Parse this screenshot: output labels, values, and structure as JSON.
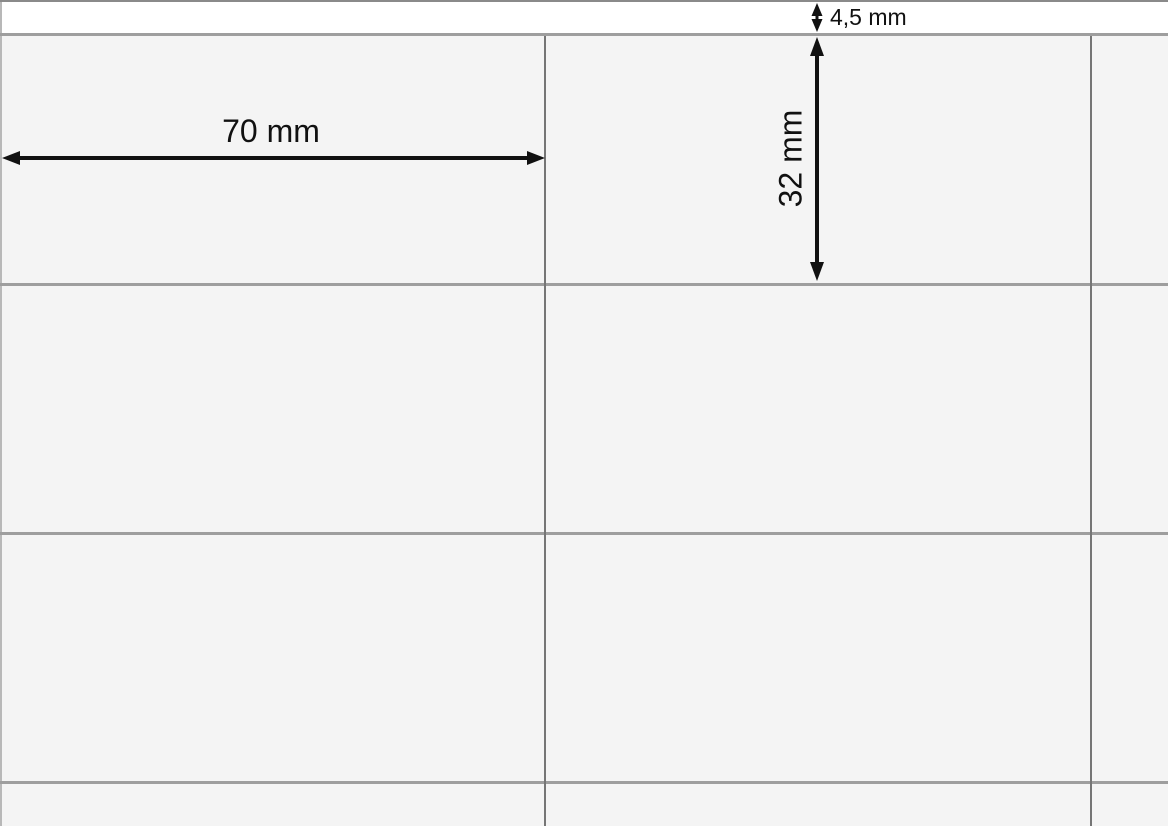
{
  "diagram": {
    "kind": "label-sheet-dimension-diagram",
    "annotations": {
      "top_margin": "4,5 mm",
      "label_width": "70 mm",
      "label_height": "32 mm"
    },
    "grid": {
      "visible_columns": 3,
      "visible_rows": 4,
      "h_lines_y": [
        33,
        283,
        532,
        781
      ],
      "v_lines_x": [
        544,
        1090
      ]
    },
    "colors": {
      "cell_background": "#f4f4f4",
      "margin_background": "#ffffff",
      "horizontal_line": "#9e9e9e",
      "vertical_line": "#757575",
      "top_edge_line": "#8a8a8a",
      "left_edge_line": "#b8b8b8",
      "annotation_ink": "#111111"
    }
  }
}
